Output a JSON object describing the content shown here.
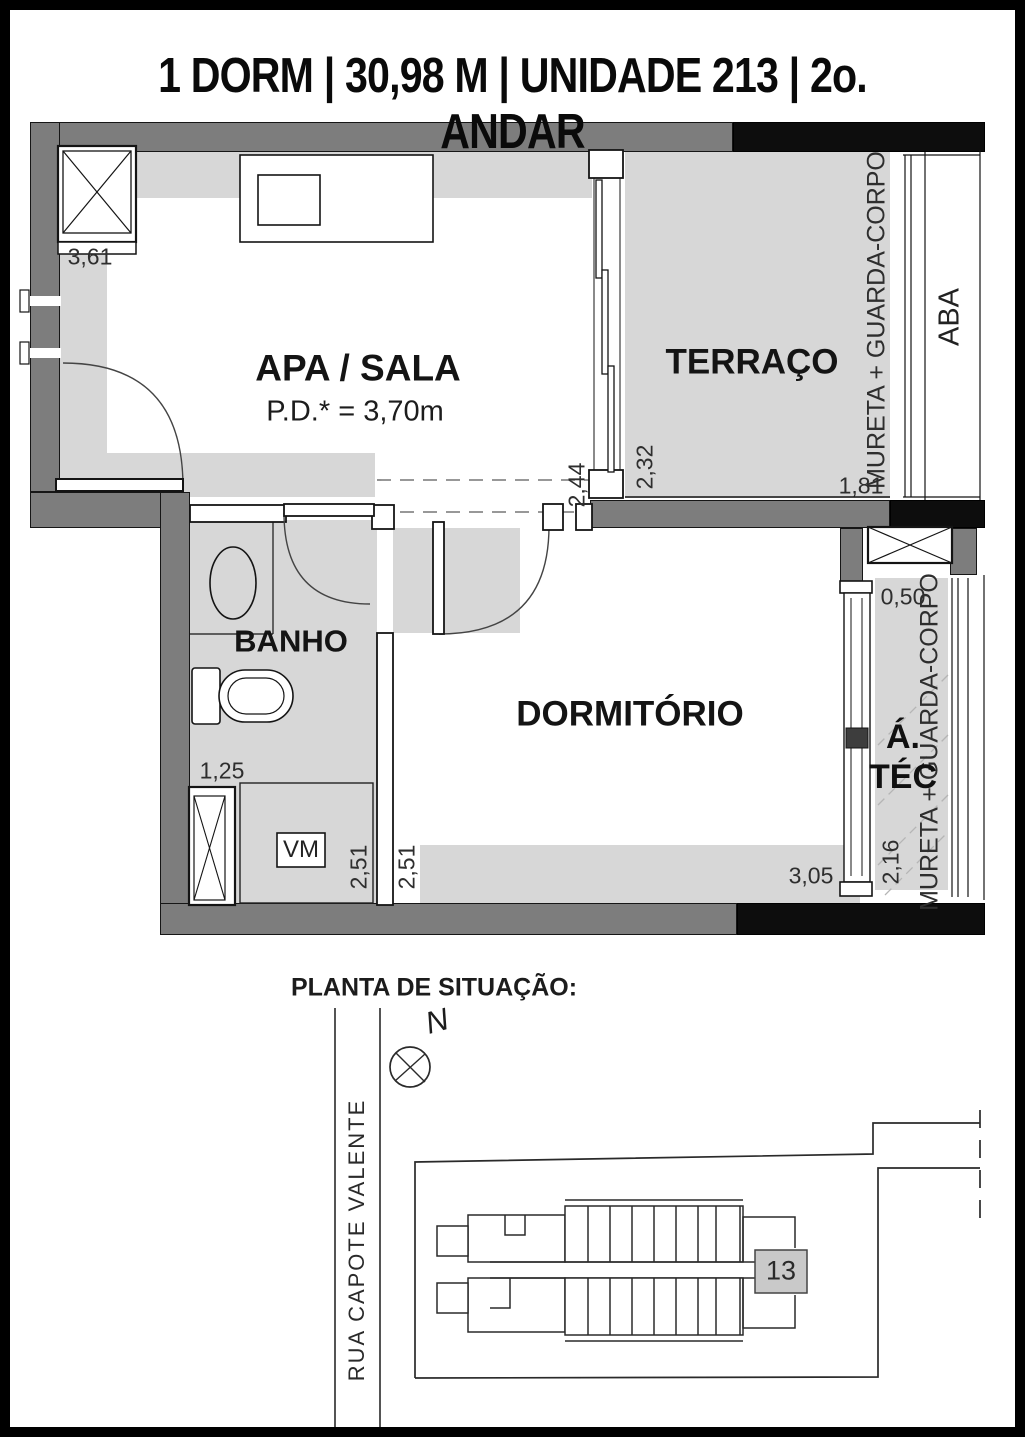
{
  "title": "1 DORM | 30,98 M | UNIDADE 213 | 2o. ANDAR",
  "plan": {
    "rooms": {
      "sala": "APA / SALA",
      "sala_pd": "P.D.* = 3,70m",
      "terraco": "TERRAÇO",
      "banho": "BANHO",
      "dormitorio": "DORMITÓRIO",
      "atec_line1": "Á.",
      "atec_line2": "TÉC",
      "vm": "VM",
      "aba": "ABA"
    },
    "mureta_top": "MURETA + GUARDA-CORPO",
    "mureta_right": "MURETA + GUARDA-CORPO",
    "dims": {
      "d361": "3,61",
      "d244": "2,44",
      "d232": "2,32",
      "d181": "1,81",
      "d050": "0,50",
      "d125": "1,25",
      "d251a": "2,51",
      "d251b": "2,51",
      "d305": "3,05",
      "d216": "2,16"
    }
  },
  "situacao": {
    "heading": "PLANTA DE SITUAÇÃO:",
    "street": "RUA CAPOTE VALENTE",
    "north": "N",
    "unit": "13"
  },
  "colors": {
    "wall_gray": "#7d7d7d",
    "wall_black": "#0d0d0d",
    "floor": "#d7d7d7",
    "unit_fill": "#c9c9c9"
  }
}
